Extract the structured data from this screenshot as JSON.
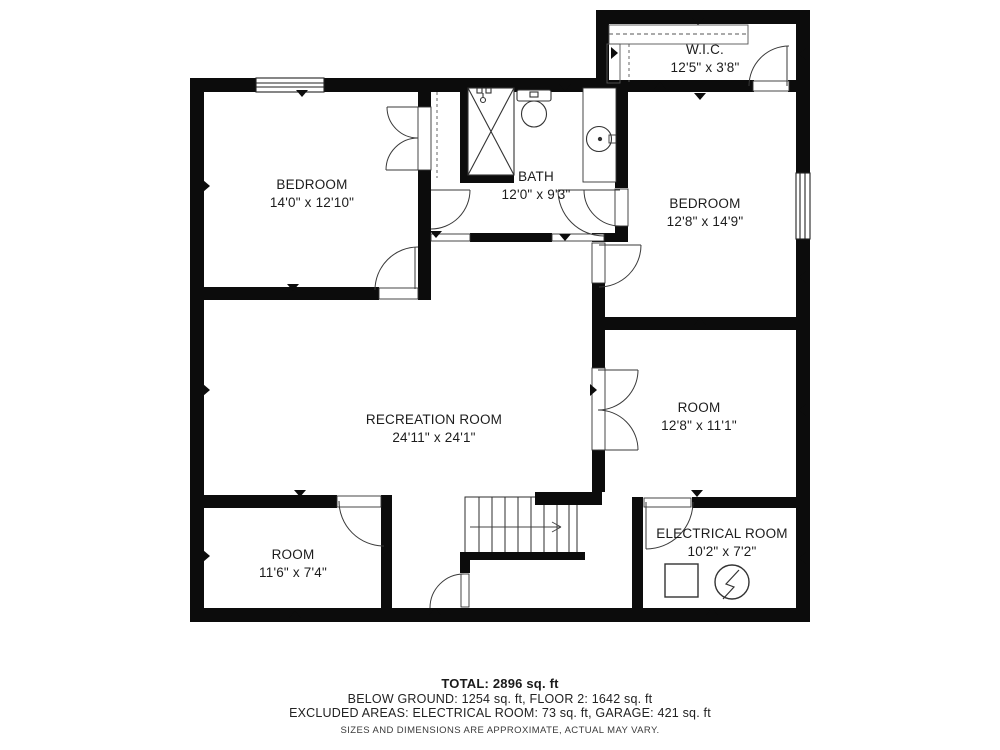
{
  "plan": {
    "rooms": [
      {
        "name": "BEDROOM",
        "dims": "14'0\" x 12'10\""
      },
      {
        "name": "BATH",
        "dims": "12'0\" x 9'3\""
      },
      {
        "name": "W.I.C.",
        "dims": "12'5\" x 3'8\""
      },
      {
        "name": "BEDROOM",
        "dims": "12'8\" x 14'9\""
      },
      {
        "name": "RECREATION ROOM",
        "dims": "24'11\" x 24'1\""
      },
      {
        "name": "ROOM",
        "dims": "12'8\" x 11'1\""
      },
      {
        "name": "ROOM",
        "dims": "11'6\" x 7'4\""
      },
      {
        "name": "ELECTRICAL ROOM",
        "dims": "10'2\" x 7'2\""
      }
    ],
    "footer": {
      "total": "TOTAL: 2896 sq. ft",
      "line2": "BELOW GROUND: 1254 sq. ft, FLOOR 2: 1642 sq. ft",
      "line3": "EXCLUDED AREAS: ELECTRICAL ROOM: 73 sq. ft, GARAGE: 421 sq. ft",
      "disclaimer": "SIZES AND DIMENSIONS ARE APPROXIMATE, ACTUAL MAY VARY."
    },
    "colors": {
      "wall": "#0c0c0c",
      "line": "#2e2e2e"
    }
  }
}
